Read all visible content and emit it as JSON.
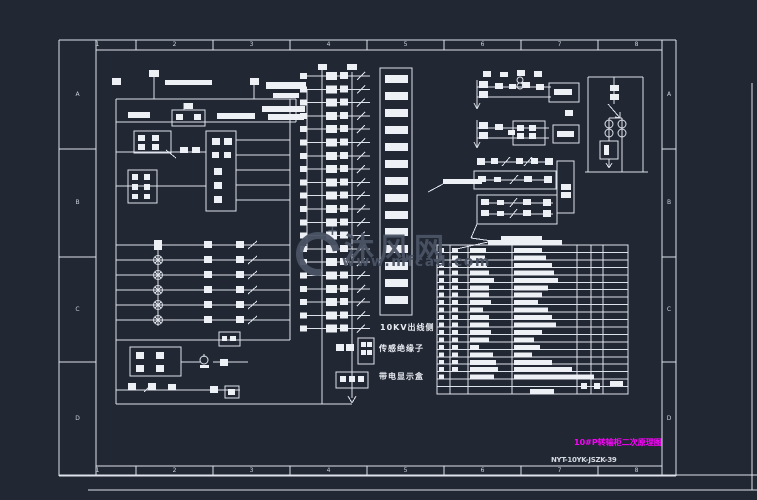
{
  "frame": {
    "column_labels": [
      "1",
      "2",
      "3",
      "4",
      "5",
      "6",
      "7",
      "8"
    ],
    "row_labels": [
      "A",
      "B",
      "C",
      "D"
    ]
  },
  "labels": {
    "outgoing_side": "10KV出线侧",
    "sensor_insulator": "传感绝缘子",
    "live_display_box": "带电显示盒"
  },
  "title_block": {
    "drawing_title": "10#P转输柜二次原理图",
    "drawing_number": "NYT-10YK-JSZK-39"
  },
  "watermark": {
    "logo_plus": "+",
    "site_name": "沐风网",
    "site_url": "www.mfcad.com"
  },
  "colors": {
    "background": "#212733",
    "line": "#dee2ea",
    "fill": "#edf0f5",
    "title_magenta": "#ff00ff",
    "watermark": "#4b5465"
  }
}
